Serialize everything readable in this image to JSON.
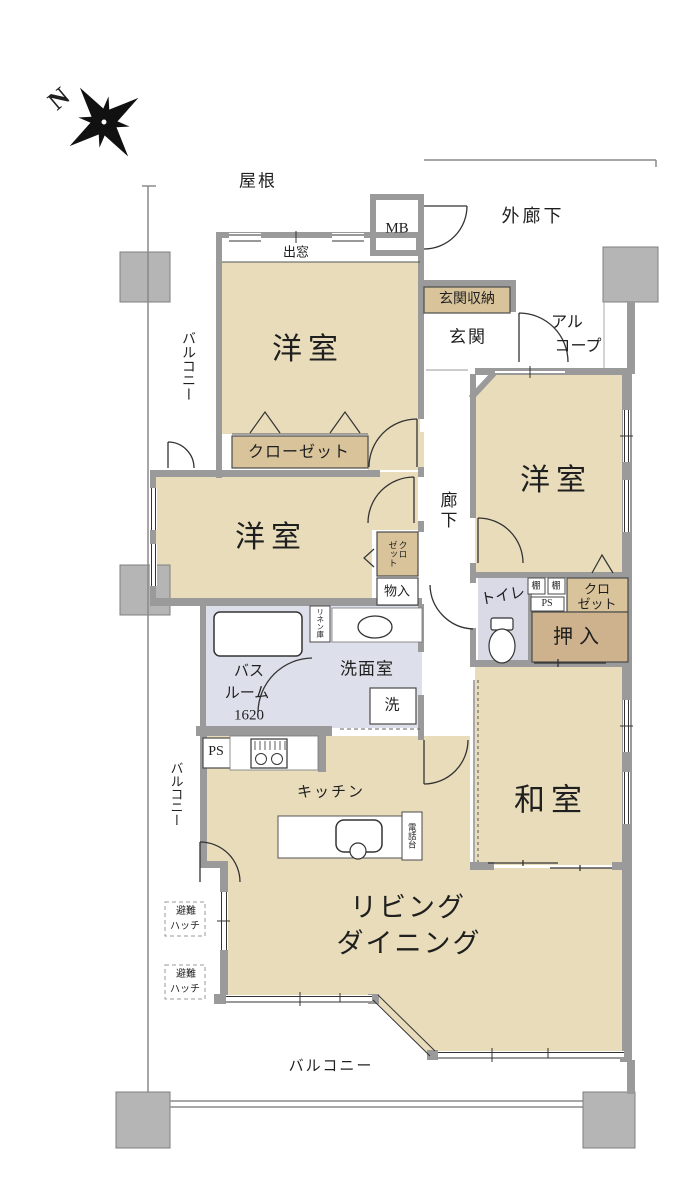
{
  "compass": {
    "north": "N"
  },
  "colors": {
    "room_fill": "#e8dcba",
    "closet_fill": "#d8c39a",
    "oshiire_fill": "#cdb28d",
    "wet_fill": "#dde0ea",
    "toilet_fill": "#d9dae6",
    "wall": "#9a9a9a",
    "pillar": "#b5b5b5",
    "line": "#333333"
  },
  "labels": {
    "roof": "屋根",
    "outer_corridor": "外廊下",
    "mb": "MB",
    "bay_window": "出窓",
    "entrance_storage": "玄関収納",
    "entrance": "玄関",
    "alcove_line1": "アル",
    "alcove_line2": "コープ",
    "balcony_left_top": "バルコニー",
    "balcony_left_bottom": "バルコニー",
    "balcony_bottom": "バルコニー",
    "western_room_1": "洋室",
    "western_room_2": "洋室",
    "western_room_3": "洋室",
    "closet_long": "クローゼット",
    "closet_small_col1": "クロ",
    "closet_small_col2": "ゼット",
    "corridor": "廊下",
    "storage": "物入",
    "toilet": "トイレ",
    "shelf_1": "棚",
    "shelf_2": "棚",
    "ps_small": "PS",
    "closet_right_line1": "クロ",
    "closet_right_line2": "ゼット",
    "oshiire": "押入",
    "bath_line1": "バス",
    "bath_line2": "ルーム",
    "bath_line3": "1620",
    "linen": "リネン庫",
    "washroom": "洗面室",
    "washer": "洗",
    "ps": "PS",
    "kitchen": "キッチン",
    "phone_stand": "電話台",
    "japanese_room": "和室",
    "living_line1": "リビング",
    "living_line2": "ダイニング",
    "hatch_line1": "避難",
    "hatch_line2": "ハッチ"
  }
}
